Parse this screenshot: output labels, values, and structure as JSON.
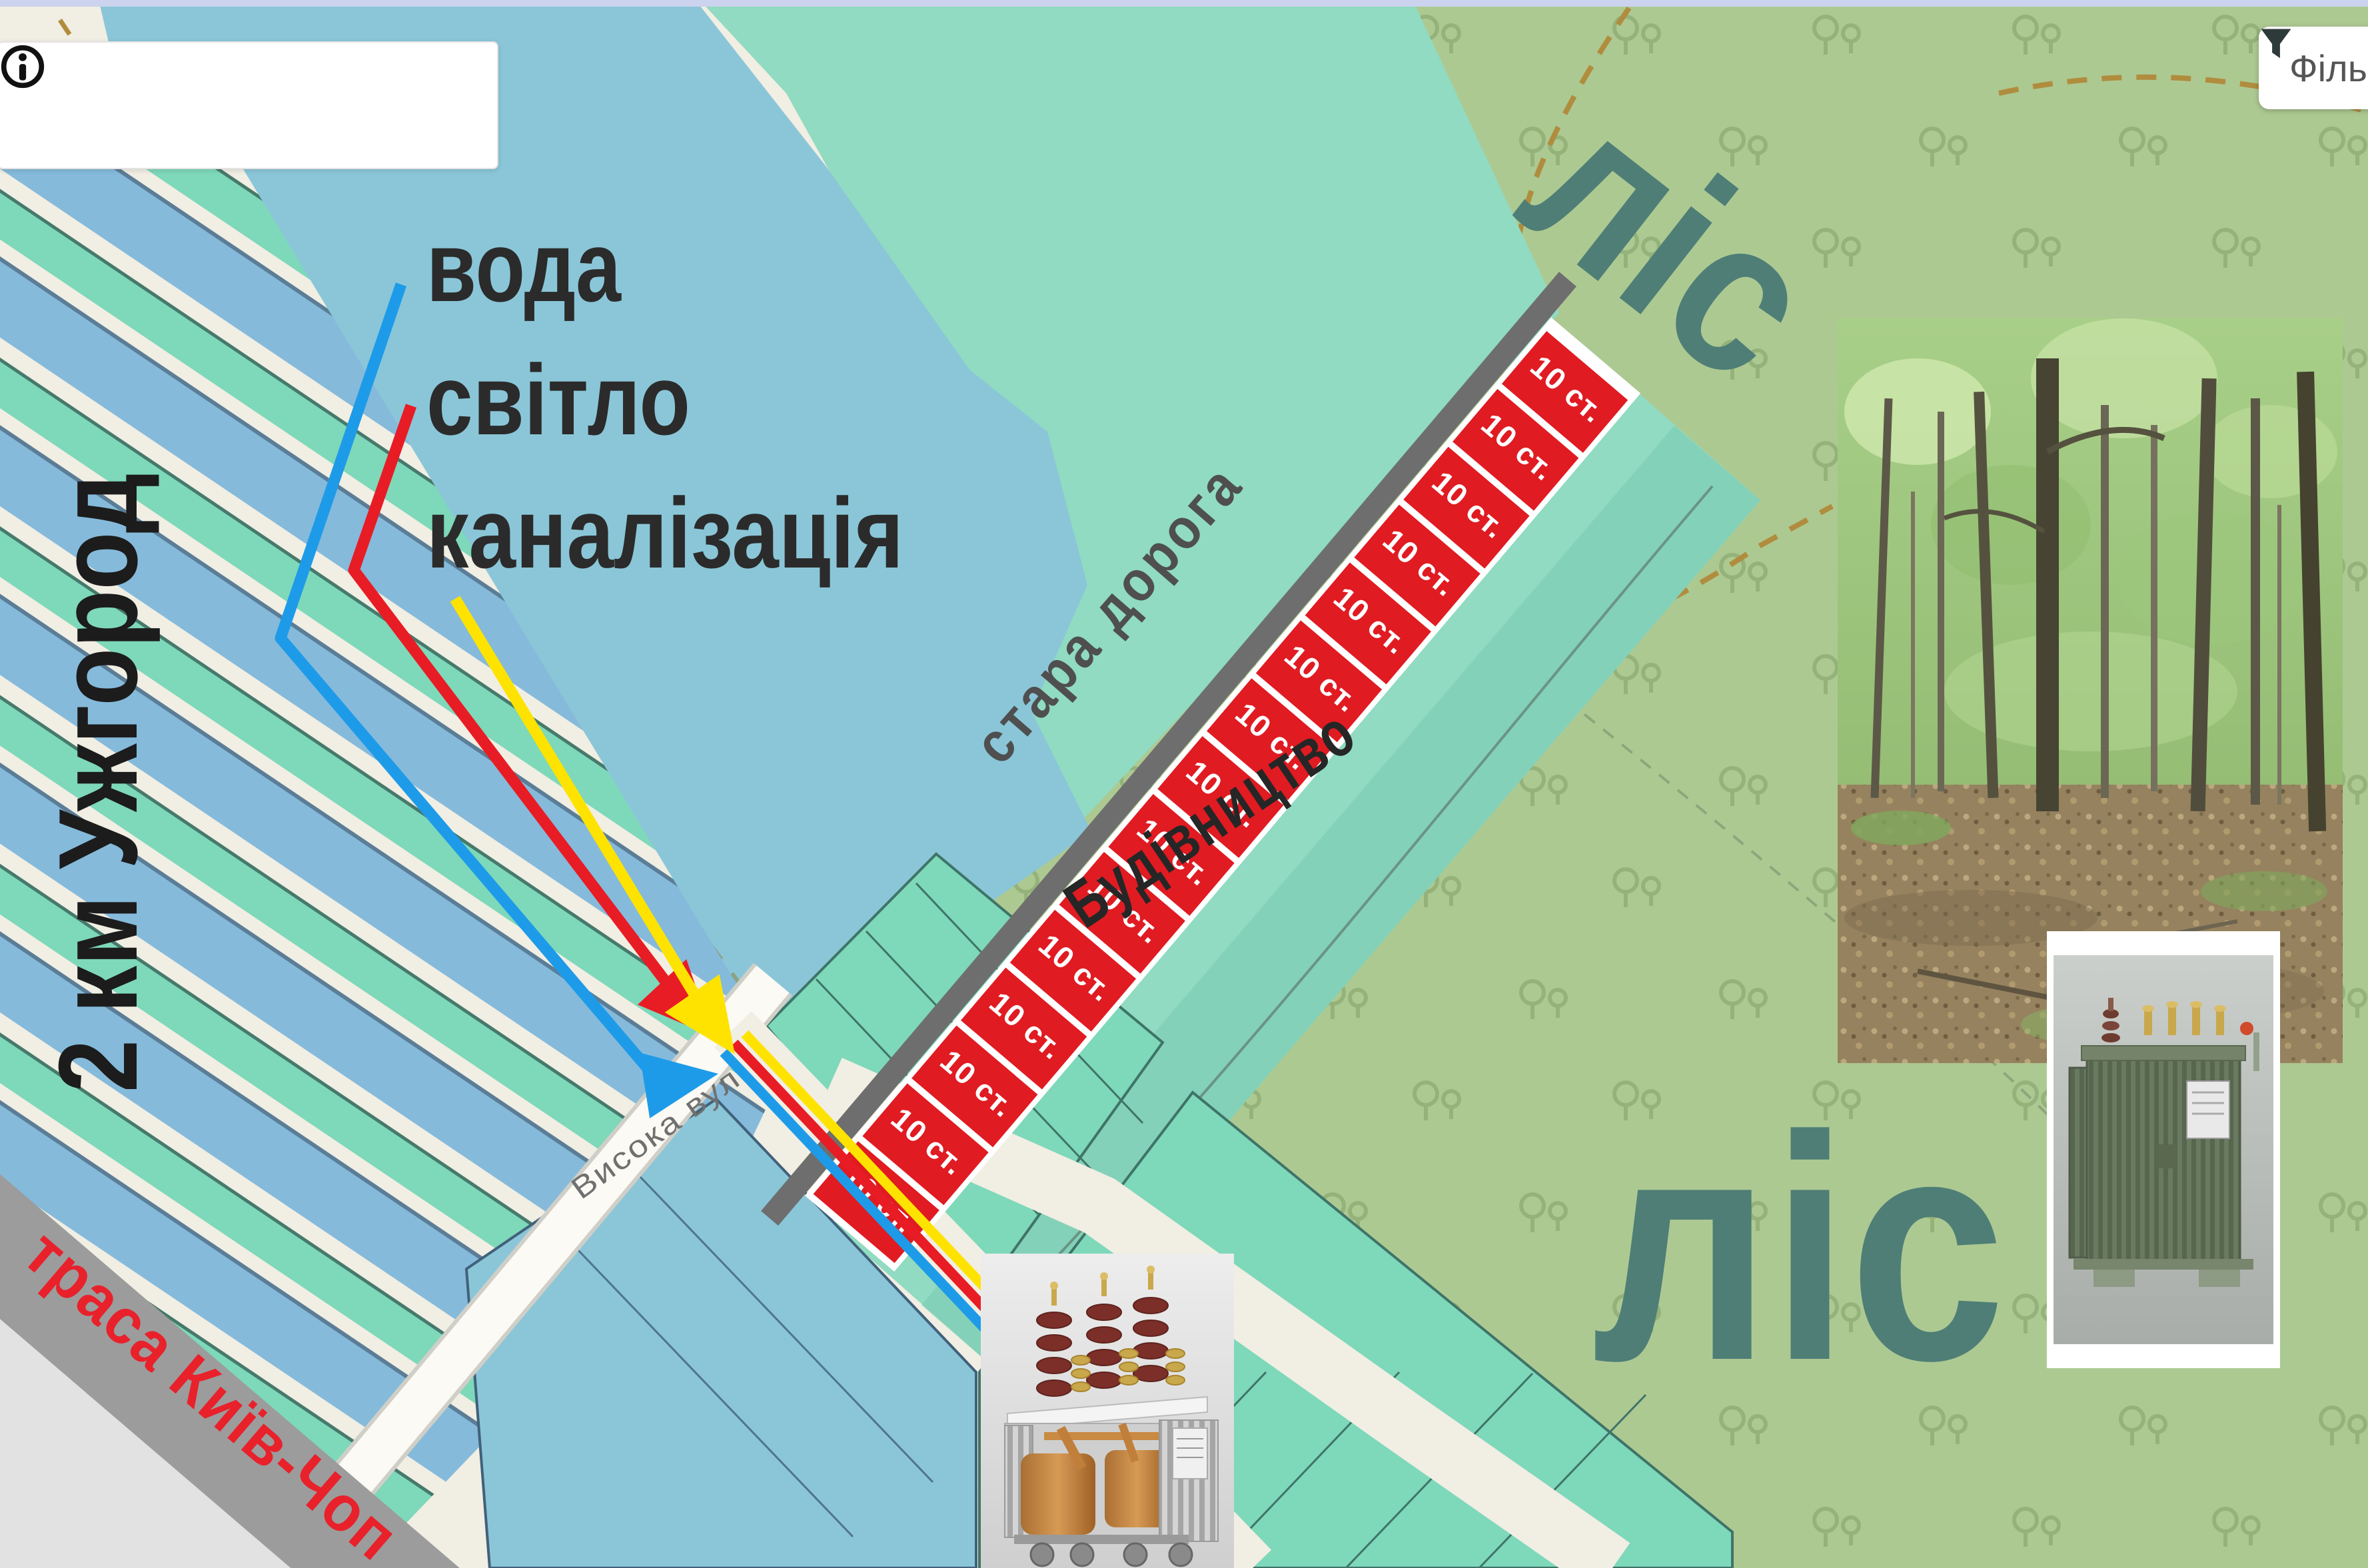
{
  "ui": {
    "top_bar_color": "#ccd3ee",
    "search": {
      "value": "",
      "placeholder": "",
      "info_icon": "info-circle-icon"
    },
    "filter": {
      "label": "Філь",
      "icon": "funnel-icon"
    }
  },
  "map": {
    "labels": {
      "water": "вода",
      "electricity": "світло",
      "sewage": "каналізація",
      "distance_marker": "2 км Ужгород",
      "old_road": "стара дорога",
      "construction_zone": "Будівництво",
      "forest_upper": "ліс",
      "forest_lower": "ліс",
      "highway": "траса Київ-Чоп",
      "street": "Висока вул"
    },
    "plots": {
      "count": 15,
      "label": "10 ст."
    },
    "lines": {
      "water_color": "#1e9be8",
      "electricity_color": "#e81c24",
      "sewage_color": "#ffe300"
    },
    "colors": {
      "lake": "#8ac6d8",
      "forest": "#adc992",
      "mint": "#90dbc1",
      "teal_plot": "#7ed8ba",
      "blue_plot": "#85badb",
      "plot_red": "#e01b22",
      "road_dark": "#6e6e6e",
      "highway_gray": "#9c9c9c",
      "forest_text": "#4e7e76"
    }
  }
}
